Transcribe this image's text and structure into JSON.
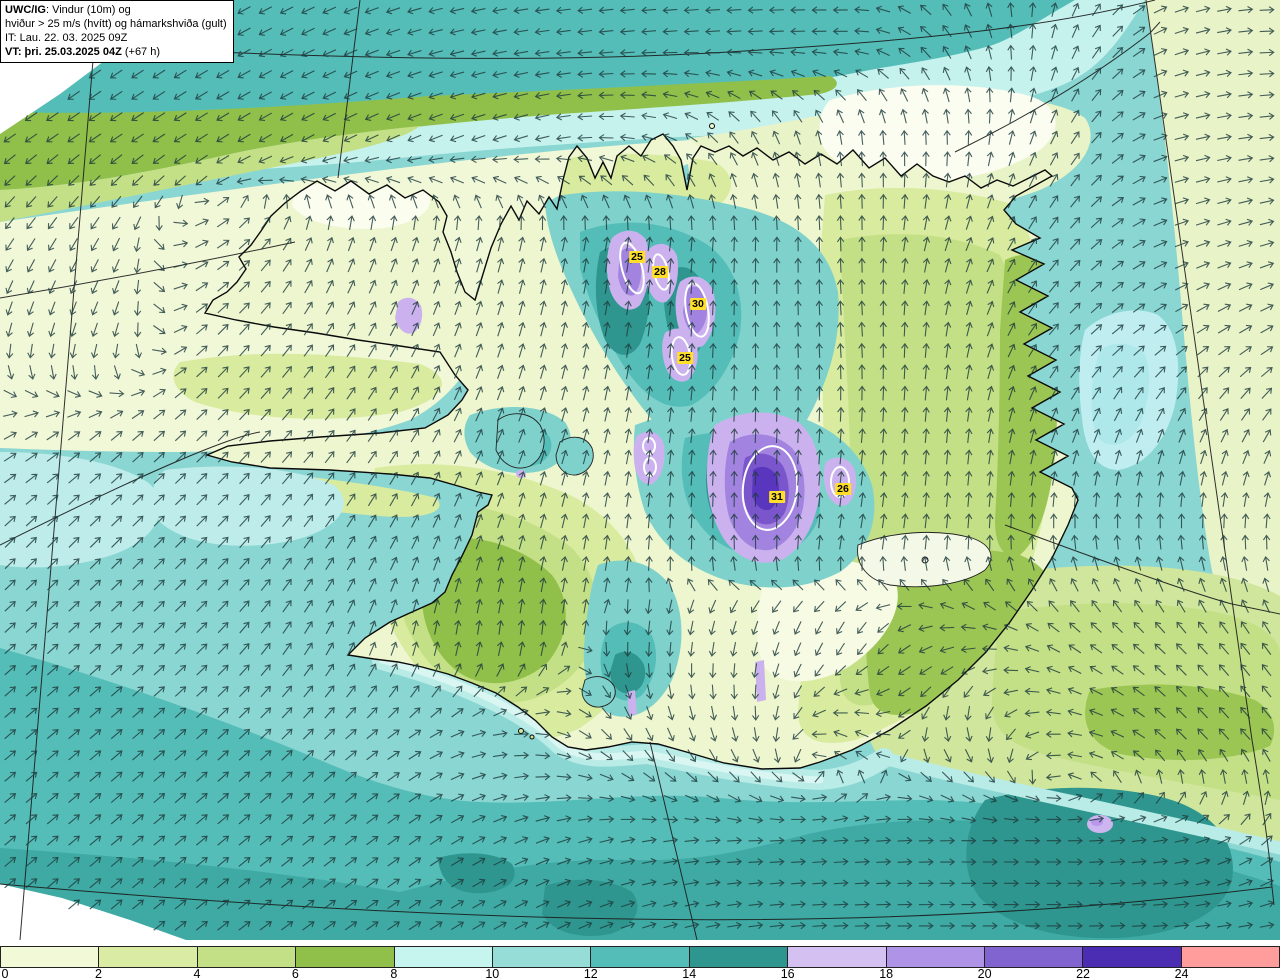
{
  "title_box": {
    "line1_bold": "UWC/IG",
    "line1_rest": ": Vindur (10m) og",
    "line2": "hviður > 25 m/s (hvítt) og hámarkshviða (gult)",
    "line3": "IT: Lau. 22. 03. 2025 09Z",
    "line4_bold": "VT: þri. 25.03.2025 04Z",
    "line4_rest": " (+67 h)"
  },
  "colorbar": {
    "ticks": [
      "0",
      "2",
      "4",
      "6",
      "8",
      "10",
      "12",
      "14",
      "16",
      "18",
      "20",
      "22",
      "24"
    ],
    "colors": [
      "#f2f9d7",
      "#daeca4",
      "#c4e086",
      "#90c04a",
      "#c6f4ef",
      "#96ddd8",
      "#55bdb8",
      "#2e968e",
      "#d5c0f2",
      "#ae93e6",
      "#8264d1",
      "#4a2db2",
      "#ff9d9d"
    ]
  },
  "gust_labels": [
    {
      "value": "25",
      "x": 637,
      "y": 257
    },
    {
      "value": "28",
      "x": 660,
      "y": 272
    },
    {
      "value": "30",
      "x": 698,
      "y": 304
    },
    {
      "value": "25",
      "x": 685,
      "y": 358
    },
    {
      "value": "31",
      "x": 777,
      "y": 497
    },
    {
      "value": "26",
      "x": 843,
      "y": 489
    }
  ],
  "palette": {
    "ocean_base": "#8ad6d2",
    "teal": "#55bdb8",
    "teal_mid": "#3faaa4",
    "teal_dark": "#2e968e",
    "cyan": "#c6f2ee",
    "lavender": "#cbb2ee",
    "purple": "#a284e0",
    "purple_deep": "#7a55cc",
    "indigo": "#5a36bf",
    "label_yellow": "#ffdf29",
    "arrow": "#1f3a3d",
    "contour_white": "#ffffff"
  },
  "wind_field": {
    "grid_x": [
      0,
      106,
      213,
      320,
      426,
      533,
      640,
      746,
      853,
      960,
      1066,
      1173,
      1280
    ],
    "grid_y": [
      40,
      140,
      240,
      340,
      440,
      540,
      640,
      740,
      840,
      920
    ],
    "angles": [
      [
        215,
        215,
        210,
        205,
        195,
        188,
        185,
        183,
        180,
        120,
        70,
        20,
        0
      ],
      [
        215,
        214,
        212,
        208,
        202,
        196,
        170,
        120,
        95,
        90,
        60,
        15,
        5
      ],
      [
        235,
        240,
        30,
        70,
        72,
        78,
        82,
        88,
        92,
        70,
        50,
        20,
        15
      ],
      [
        258,
        252,
        45,
        55,
        65,
        75,
        82,
        90,
        95,
        80,
        45,
        35,
        30
      ],
      [
        30,
        40,
        45,
        50,
        60,
        70,
        80,
        88,
        85,
        85,
        70,
        70,
        60
      ],
      [
        45,
        45,
        45,
        55,
        65,
        75,
        85,
        92,
        80,
        85,
        95,
        95,
        90
      ],
      [
        42,
        42,
        45,
        60,
        80,
        85,
        265,
        255,
        240,
        185,
        145,
        135,
        125
      ],
      [
        40,
        40,
        42,
        45,
        30,
        355,
        300,
        285,
        150,
        290,
        175,
        135,
        130
      ],
      [
        40,
        40,
        40,
        38,
        35,
        22,
        10,
        2,
        5,
        0,
        0,
        10,
        45
      ],
      [
        40,
        40,
        38,
        36,
        33,
        28,
        18,
        8,
        2,
        0,
        0,
        5,
        12
      ]
    ],
    "spacing": 21.3,
    "arrow_length": 14
  }
}
